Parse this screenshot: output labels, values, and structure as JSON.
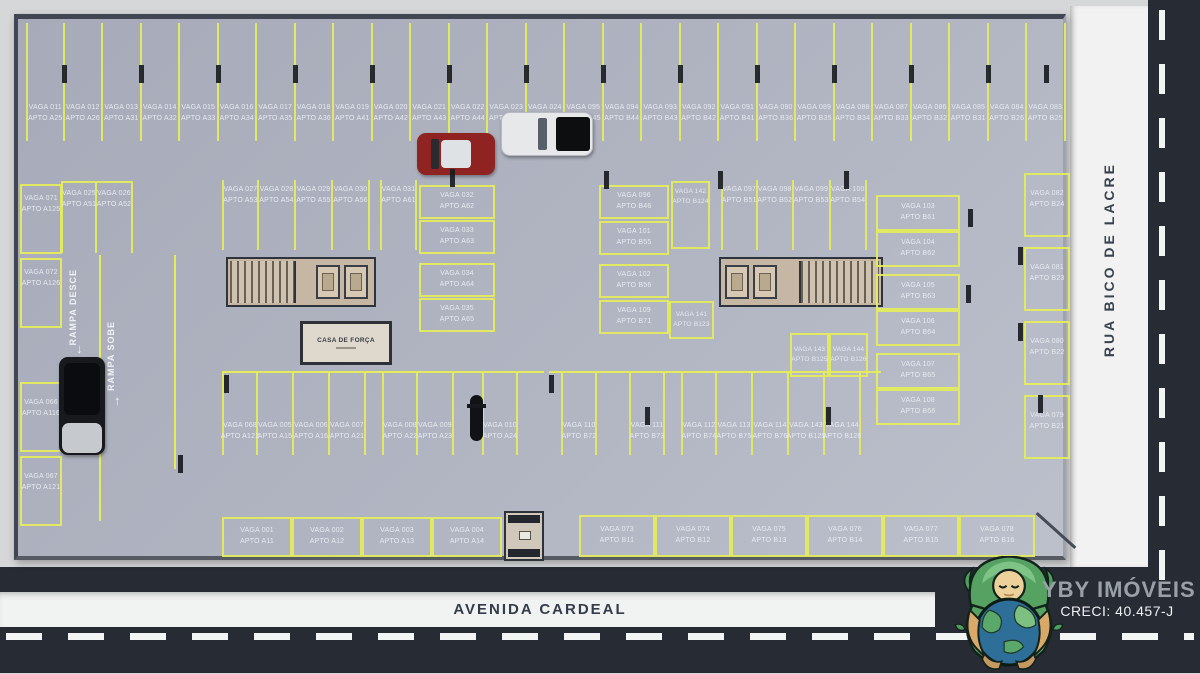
{
  "streets": {
    "bottom": "AVENIDA CARDEAL",
    "right": "RUA BICO DE LACRE"
  },
  "ramps": {
    "down": "RAMPA DESCE",
    "up": "RAMPA SOBE"
  },
  "facilities": {
    "power_house": "CASA DE FORÇA"
  },
  "branding": {
    "company": "YBY IMÓVEIS",
    "creci": "CRECI: 40.457-J"
  },
  "colors": {
    "stall_line": "#e4ec5e",
    "floor": "#adb1bf",
    "asphalt": "#262b34",
    "sidewalk": "#f2f2f3"
  },
  "stalls": {
    "top": [
      {
        "vaga": "VAGA 011",
        "apto": "APTO A25"
      },
      {
        "vaga": "VAGA 012",
        "apto": "APTO A26"
      },
      {
        "vaga": "VAGA 013",
        "apto": "APTO A31"
      },
      {
        "vaga": "VAGA 014",
        "apto": "APTO A32"
      },
      {
        "vaga": "VAGA 015",
        "apto": "APTO A33"
      },
      {
        "vaga": "VAGA 016",
        "apto": "APTO A34"
      },
      {
        "vaga": "VAGA 017",
        "apto": "APTO A35"
      },
      {
        "vaga": "VAGA 018",
        "apto": "APTO A36"
      },
      {
        "vaga": "VAGA 019",
        "apto": "APTO A41"
      },
      {
        "vaga": "VAGA 020",
        "apto": "APTO A42"
      },
      {
        "vaga": "VAGA 021",
        "apto": "APTO A43"
      },
      {
        "vaga": "VAGA 022",
        "apto": "APTO A44"
      },
      {
        "vaga": "VAGA 023",
        "apto": "APTO A45"
      },
      {
        "vaga": "VAGA 024",
        "apto": "APTO A46"
      },
      {
        "vaga": "VAGA 095",
        "apto": "APTO B45"
      },
      {
        "vaga": "VAGA 094",
        "apto": "APTO B44"
      },
      {
        "vaga": "VAGA 093",
        "apto": "APTO B43"
      },
      {
        "vaga": "VAGA 092",
        "apto": "APTO B42"
      },
      {
        "vaga": "VAGA 091",
        "apto": "APTO B41"
      },
      {
        "vaga": "VAGA 090",
        "apto": "APTO B36"
      },
      {
        "vaga": "VAGA 089",
        "apto": "APTO B35"
      },
      {
        "vaga": "VAGA 088",
        "apto": "APTO B34"
      },
      {
        "vaga": "VAGA 087",
        "apto": "APTO B33"
      },
      {
        "vaga": "VAGA 086",
        "apto": "APTO B32"
      },
      {
        "vaga": "VAGA 085",
        "apto": "APTO B31"
      },
      {
        "vaga": "VAGA 084",
        "apto": "APTO B26"
      },
      {
        "vaga": "VAGA 083",
        "apto": "APTO B25"
      }
    ],
    "pair_25_26": [
      {
        "vaga": "VAGA 025",
        "apto": "APTO A51"
      },
      {
        "vaga": "VAGA 026",
        "apto": "APTO A52"
      }
    ],
    "left_top": [
      {
        "vaga": "VAGA 071",
        "apto": "APTO A125"
      },
      {
        "vaga": "VAGA 072",
        "apto": "APTO A126"
      }
    ],
    "left_bottom": [
      {
        "vaga": "VAGA 066",
        "apto": "APTO A116"
      },
      {
        "vaga": "VAGA 067",
        "apto": "APTO A121"
      }
    ],
    "row2": [
      {
        "vaga": "VAGA 027",
        "apto": "APTO A53"
      },
      {
        "vaga": "VAGA 028",
        "apto": "APTO A54"
      },
      {
        "vaga": "VAGA 029",
        "apto": "APTO A55"
      },
      {
        "vaga": "VAGA 030",
        "apto": "APTO A56"
      },
      {
        "vaga": "VAGA 031",
        "apto": "APTO A61"
      }
    ],
    "stack_a": [
      {
        "vaga": "VAGA 032",
        "apto": "APTO A62"
      },
      {
        "vaga": "VAGA 033",
        "apto": "APTO A63"
      },
      {
        "vaga": "VAGA 034",
        "apto": "APTO A64"
      },
      {
        "vaga": "VAGA 035",
        "apto": "APTO A65"
      }
    ],
    "row3_left": [
      {
        "vaga": "VAGA 068",
        "apto": "APTO A122"
      },
      {
        "vaga": "VAGA 005",
        "apto": "APTO A15"
      },
      {
        "vaga": "VAGA 006",
        "apto": "APTO A16"
      },
      {
        "vaga": "VAGA 007",
        "apto": "APTO A21"
      },
      {
        "vaga": "VAGA 008",
        "apto": "APTO A22"
      },
      {
        "vaga": "VAGA 009",
        "apto": "APTO A23"
      },
      {
        "vaga": "VAGA 010",
        "apto": "APTO A24"
      }
    ],
    "row3_right": [
      {
        "vaga": "VAGA 110",
        "apto": "APTO B72"
      },
      {
        "vaga": "VAGA 111",
        "apto": "APTO B73"
      },
      {
        "vaga": "VAGA 112",
        "apto": "APTO B74"
      },
      {
        "vaga": "VAGA 113",
        "apto": "APTO B75"
      },
      {
        "vaga": "VAGA 114",
        "apto": "APTO B76"
      },
      {
        "vaga": "VAGA 143",
        "apto": "APTO B125"
      },
      {
        "vaga": "VAGA 144",
        "apto": "APTO B126"
      }
    ],
    "stack_b": [
      {
        "vaga": "VAGA 096",
        "apto": "APTO B46"
      },
      {
        "vaga": "VAGA 101",
        "apto": "APTO B55"
      },
      {
        "vaga": "VAGA 102",
        "apto": "APTO B56"
      },
      {
        "vaga": "VAGA 109",
        "apto": "APTO B71"
      }
    ],
    "narrow_top": [
      {
        "vaga": "VAGA 142",
        "apto": "APTO B124"
      }
    ],
    "narrow_mid": [
      {
        "vaga": "VAGA 141",
        "apto": "APTO B123"
      }
    ],
    "row4": [
      {
        "vaga": "VAGA 097",
        "apto": "APTO B51"
      },
      {
        "vaga": "VAGA 098",
        "apto": "APTO B52"
      },
      {
        "vaga": "VAGA 099",
        "apto": "APTO B53"
      },
      {
        "vaga": "VAGA 100",
        "apto": "APTO B54"
      }
    ],
    "pair_c": [
      {
        "vaga": "VAGA 143",
        "apto": "APTO B125"
      },
      {
        "vaga": "VAGA 144",
        "apto": "APTO B126"
      }
    ],
    "stack_c": [
      {
        "vaga": "VAGA 103",
        "apto": "APTO B61"
      },
      {
        "vaga": "VAGA 104",
        "apto": "APTO B62"
      },
      {
        "vaga": "VAGA 105",
        "apto": "APTO B63"
      },
      {
        "vaga": "VAGA 106",
        "apto": "APTO B64"
      },
      {
        "vaga": "VAGA 107",
        "apto": "APTO B65"
      },
      {
        "vaga": "VAGA 108",
        "apto": "APTO B66"
      }
    ],
    "right_col": [
      {
        "vaga": "VAGA 082",
        "apto": "APTO B24"
      },
      {
        "vaga": "VAGA 081",
        "apto": "APTO B23"
      },
      {
        "vaga": "VAGA 080",
        "apto": "APTO B22"
      },
      {
        "vaga": "VAGA 079",
        "apto": "APTO B21"
      }
    ],
    "bottom_left": [
      {
        "vaga": "VAGA 001",
        "apto": "APTO A11"
      },
      {
        "vaga": "VAGA 002",
        "apto": "APTO A12"
      },
      {
        "vaga": "VAGA 003",
        "apto": "APTO A13"
      },
      {
        "vaga": "VAGA 004",
        "apto": "APTO A14"
      }
    ],
    "bottom_right": [
      {
        "vaga": "VAGA 073",
        "apto": "APTO B11"
      },
      {
        "vaga": "VAGA 074",
        "apto": "APTO B12"
      },
      {
        "vaga": "VAGA 075",
        "apto": "APTO B13"
      },
      {
        "vaga": "VAGA 076",
        "apto": "APTO B14"
      },
      {
        "vaga": "VAGA 077",
        "apto": "APTO B15"
      },
      {
        "vaga": "VAGA 078",
        "apto": "APTO B16"
      }
    ]
  }
}
